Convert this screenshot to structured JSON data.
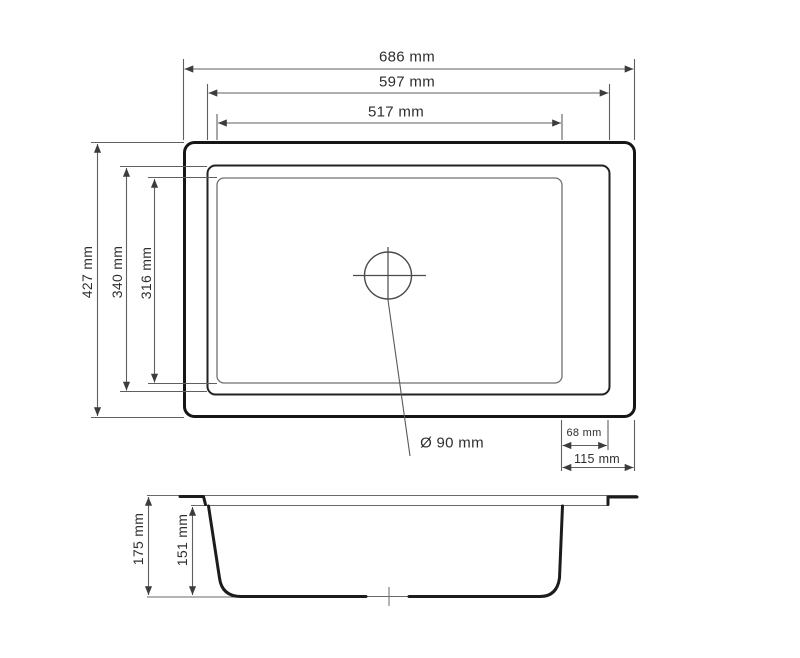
{
  "colors": {
    "outline_dark": "#1a1a1a",
    "outline_mid": "#222222",
    "line_thin": "#6a6a6a",
    "dim_line": "#5f5f5f",
    "text": "#2e2e2e",
    "background": "#ffffff"
  },
  "top_view": {
    "horizontal_dimensions": [
      {
        "name": "overall-width",
        "label": "686 mm"
      },
      {
        "name": "rim-width",
        "label": "597 mm"
      },
      {
        "name": "bowl-width",
        "label": "517 mm"
      }
    ],
    "vertical_dimensions": [
      {
        "name": "overall-depth",
        "label": "427 mm"
      },
      {
        "name": "rim-depth",
        "label": "340 mm"
      },
      {
        "name": "bowl-depth",
        "label": "316 mm"
      }
    ],
    "offset_dimensions": [
      {
        "name": "bowl-to-rim-offset",
        "label": "68 mm"
      },
      {
        "name": "bowl-to-edge-offset",
        "label": "115 mm"
      }
    ],
    "drain_dimension": {
      "label": "Ø 90 mm"
    }
  },
  "section_view": {
    "vertical_dimensions": [
      {
        "name": "overall-height",
        "label": "175 mm"
      },
      {
        "name": "bowl-inner-depth",
        "label": "151 mm"
      }
    ]
  }
}
